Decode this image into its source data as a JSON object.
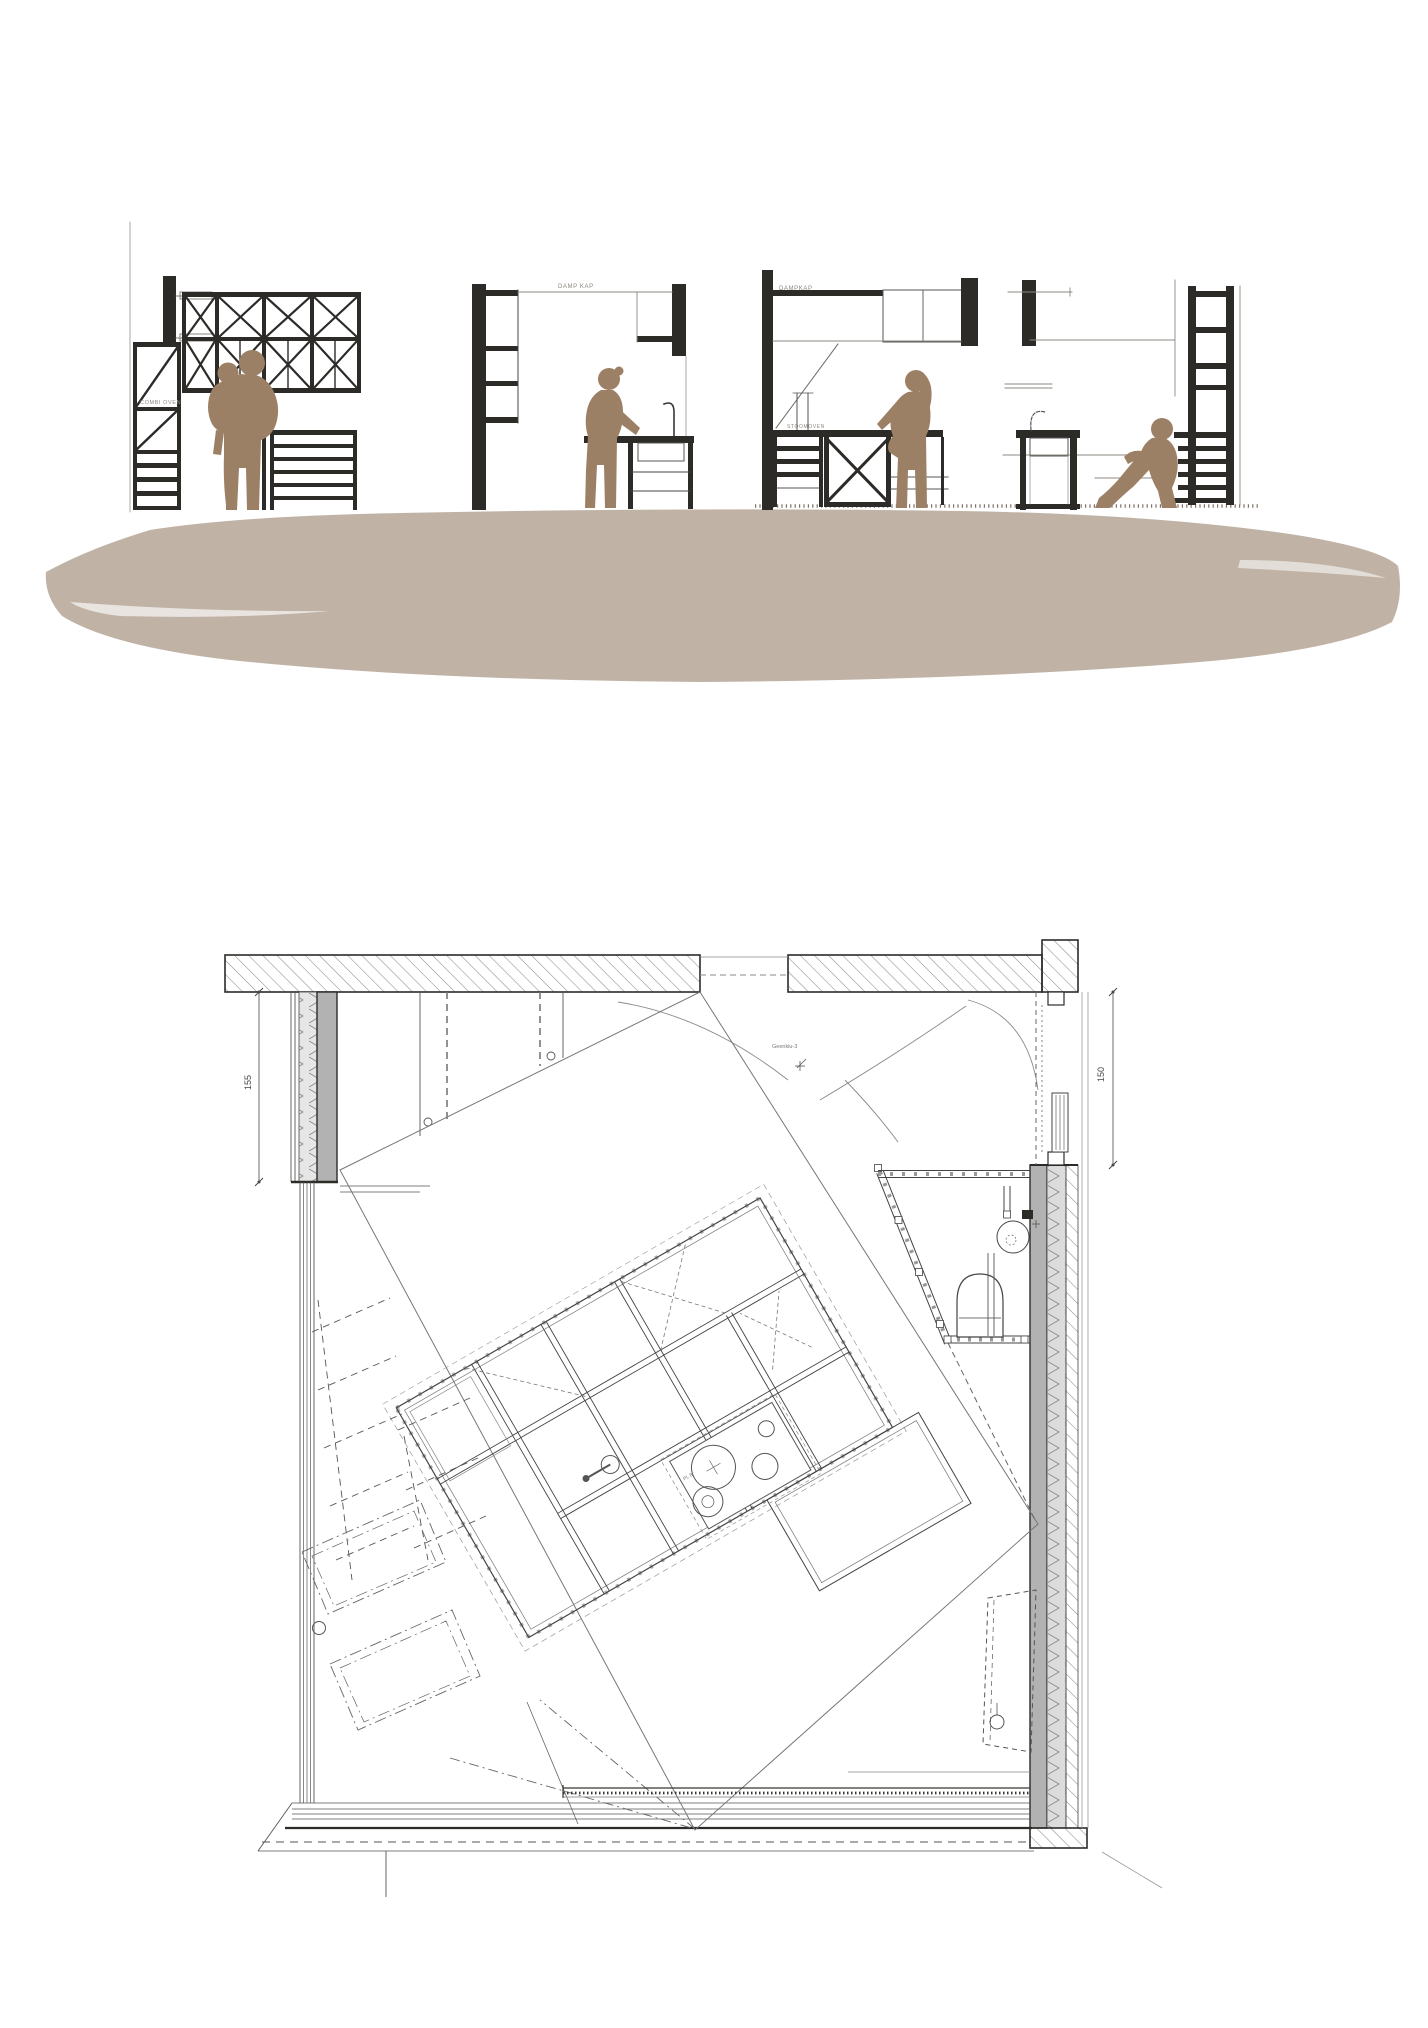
{
  "palette": {
    "ink": "#2d2b28",
    "line_gray": "#8a8a8a",
    "figure_brown": "#9c8065",
    "ground_band": "#c0b3a6",
    "wall_gray": "#b2b2b2"
  },
  "elevations": {
    "section1": {
      "appliance_label": "COMBI OVEN"
    },
    "section2": {
      "hood_label": "DAMP KAP"
    },
    "section3": {
      "hood_label": "DAMPKAP",
      "appliance_label": "STOOMOVEN"
    },
    "section4": {}
  },
  "plan": {
    "dim_left": "155",
    "dim_right": "150",
    "note": "Geenklu-3",
    "cooktop_label": "PL 8"
  }
}
